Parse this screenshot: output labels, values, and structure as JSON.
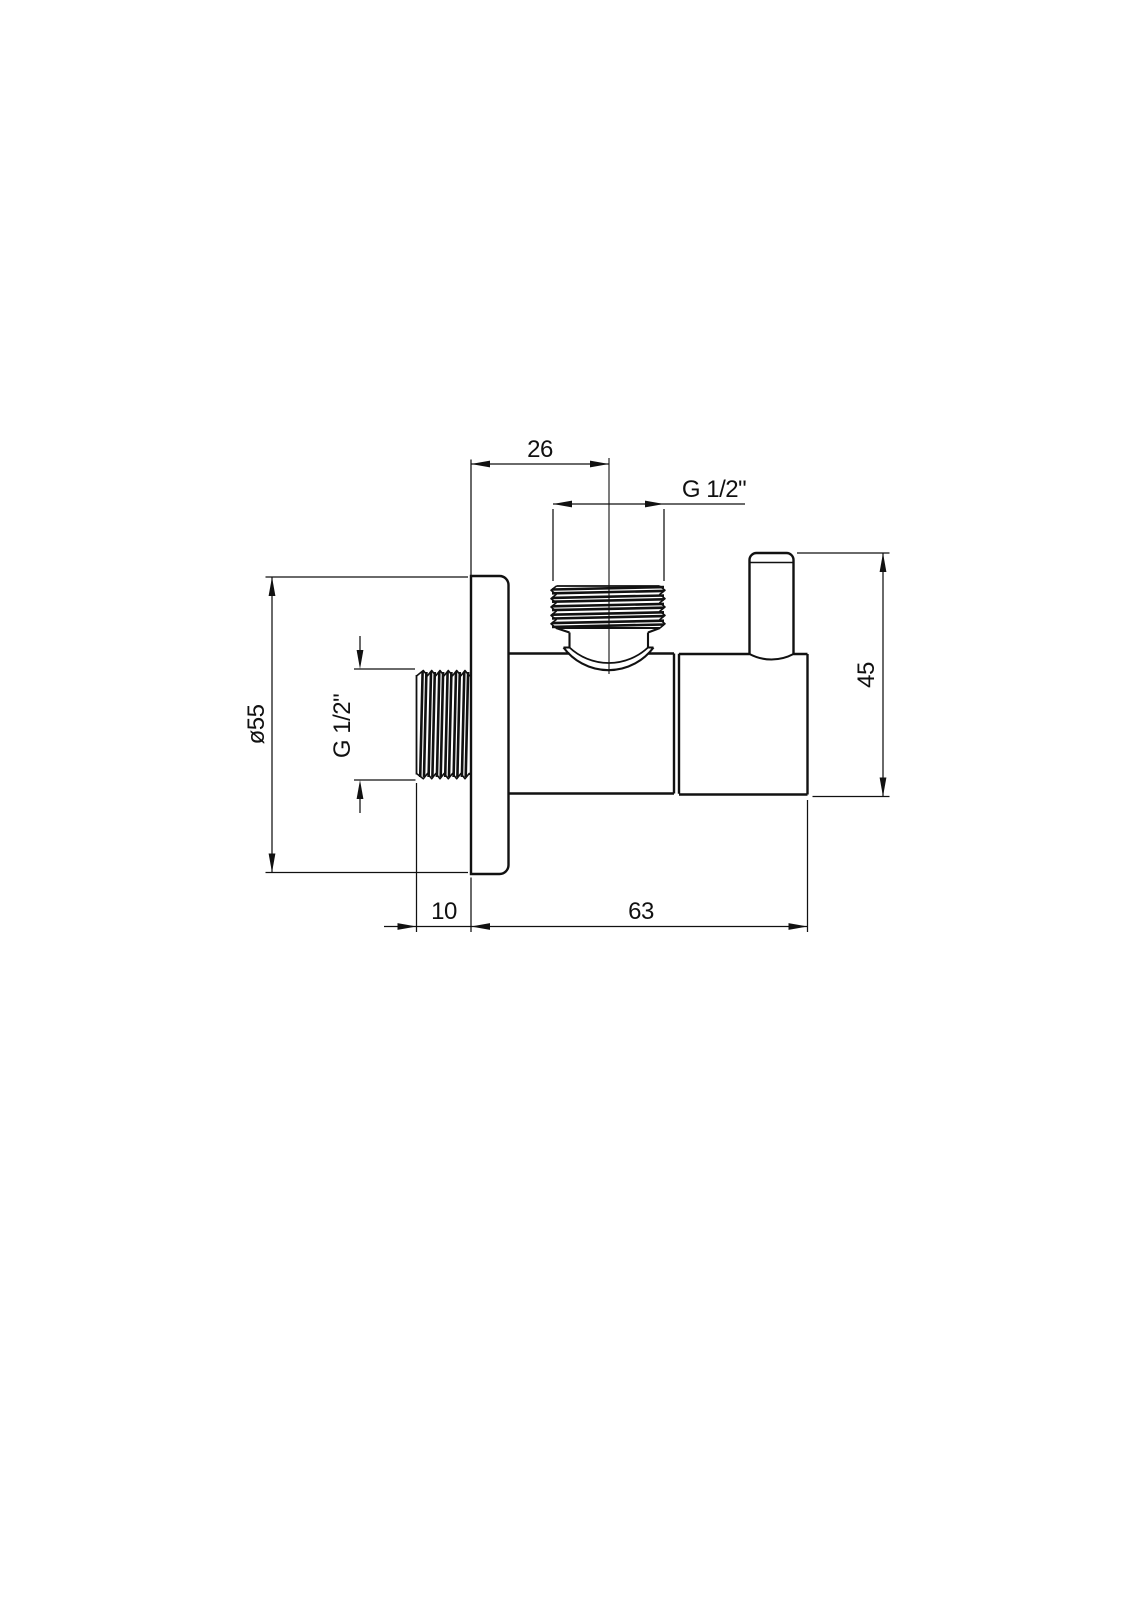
{
  "drawing": {
    "background_color": "#ffffff",
    "line_color": "#111111",
    "labels": {
      "dim_wall_to_outlet_center": "26",
      "dim_outlet_thread": "G 1/2\"",
      "dim_plate_diameter": "ø55",
      "dim_inlet_thread": "G 1/2\"",
      "dim_height": "45",
      "dim_thread_protrusion": "10",
      "dim_body_length": "63"
    }
  }
}
